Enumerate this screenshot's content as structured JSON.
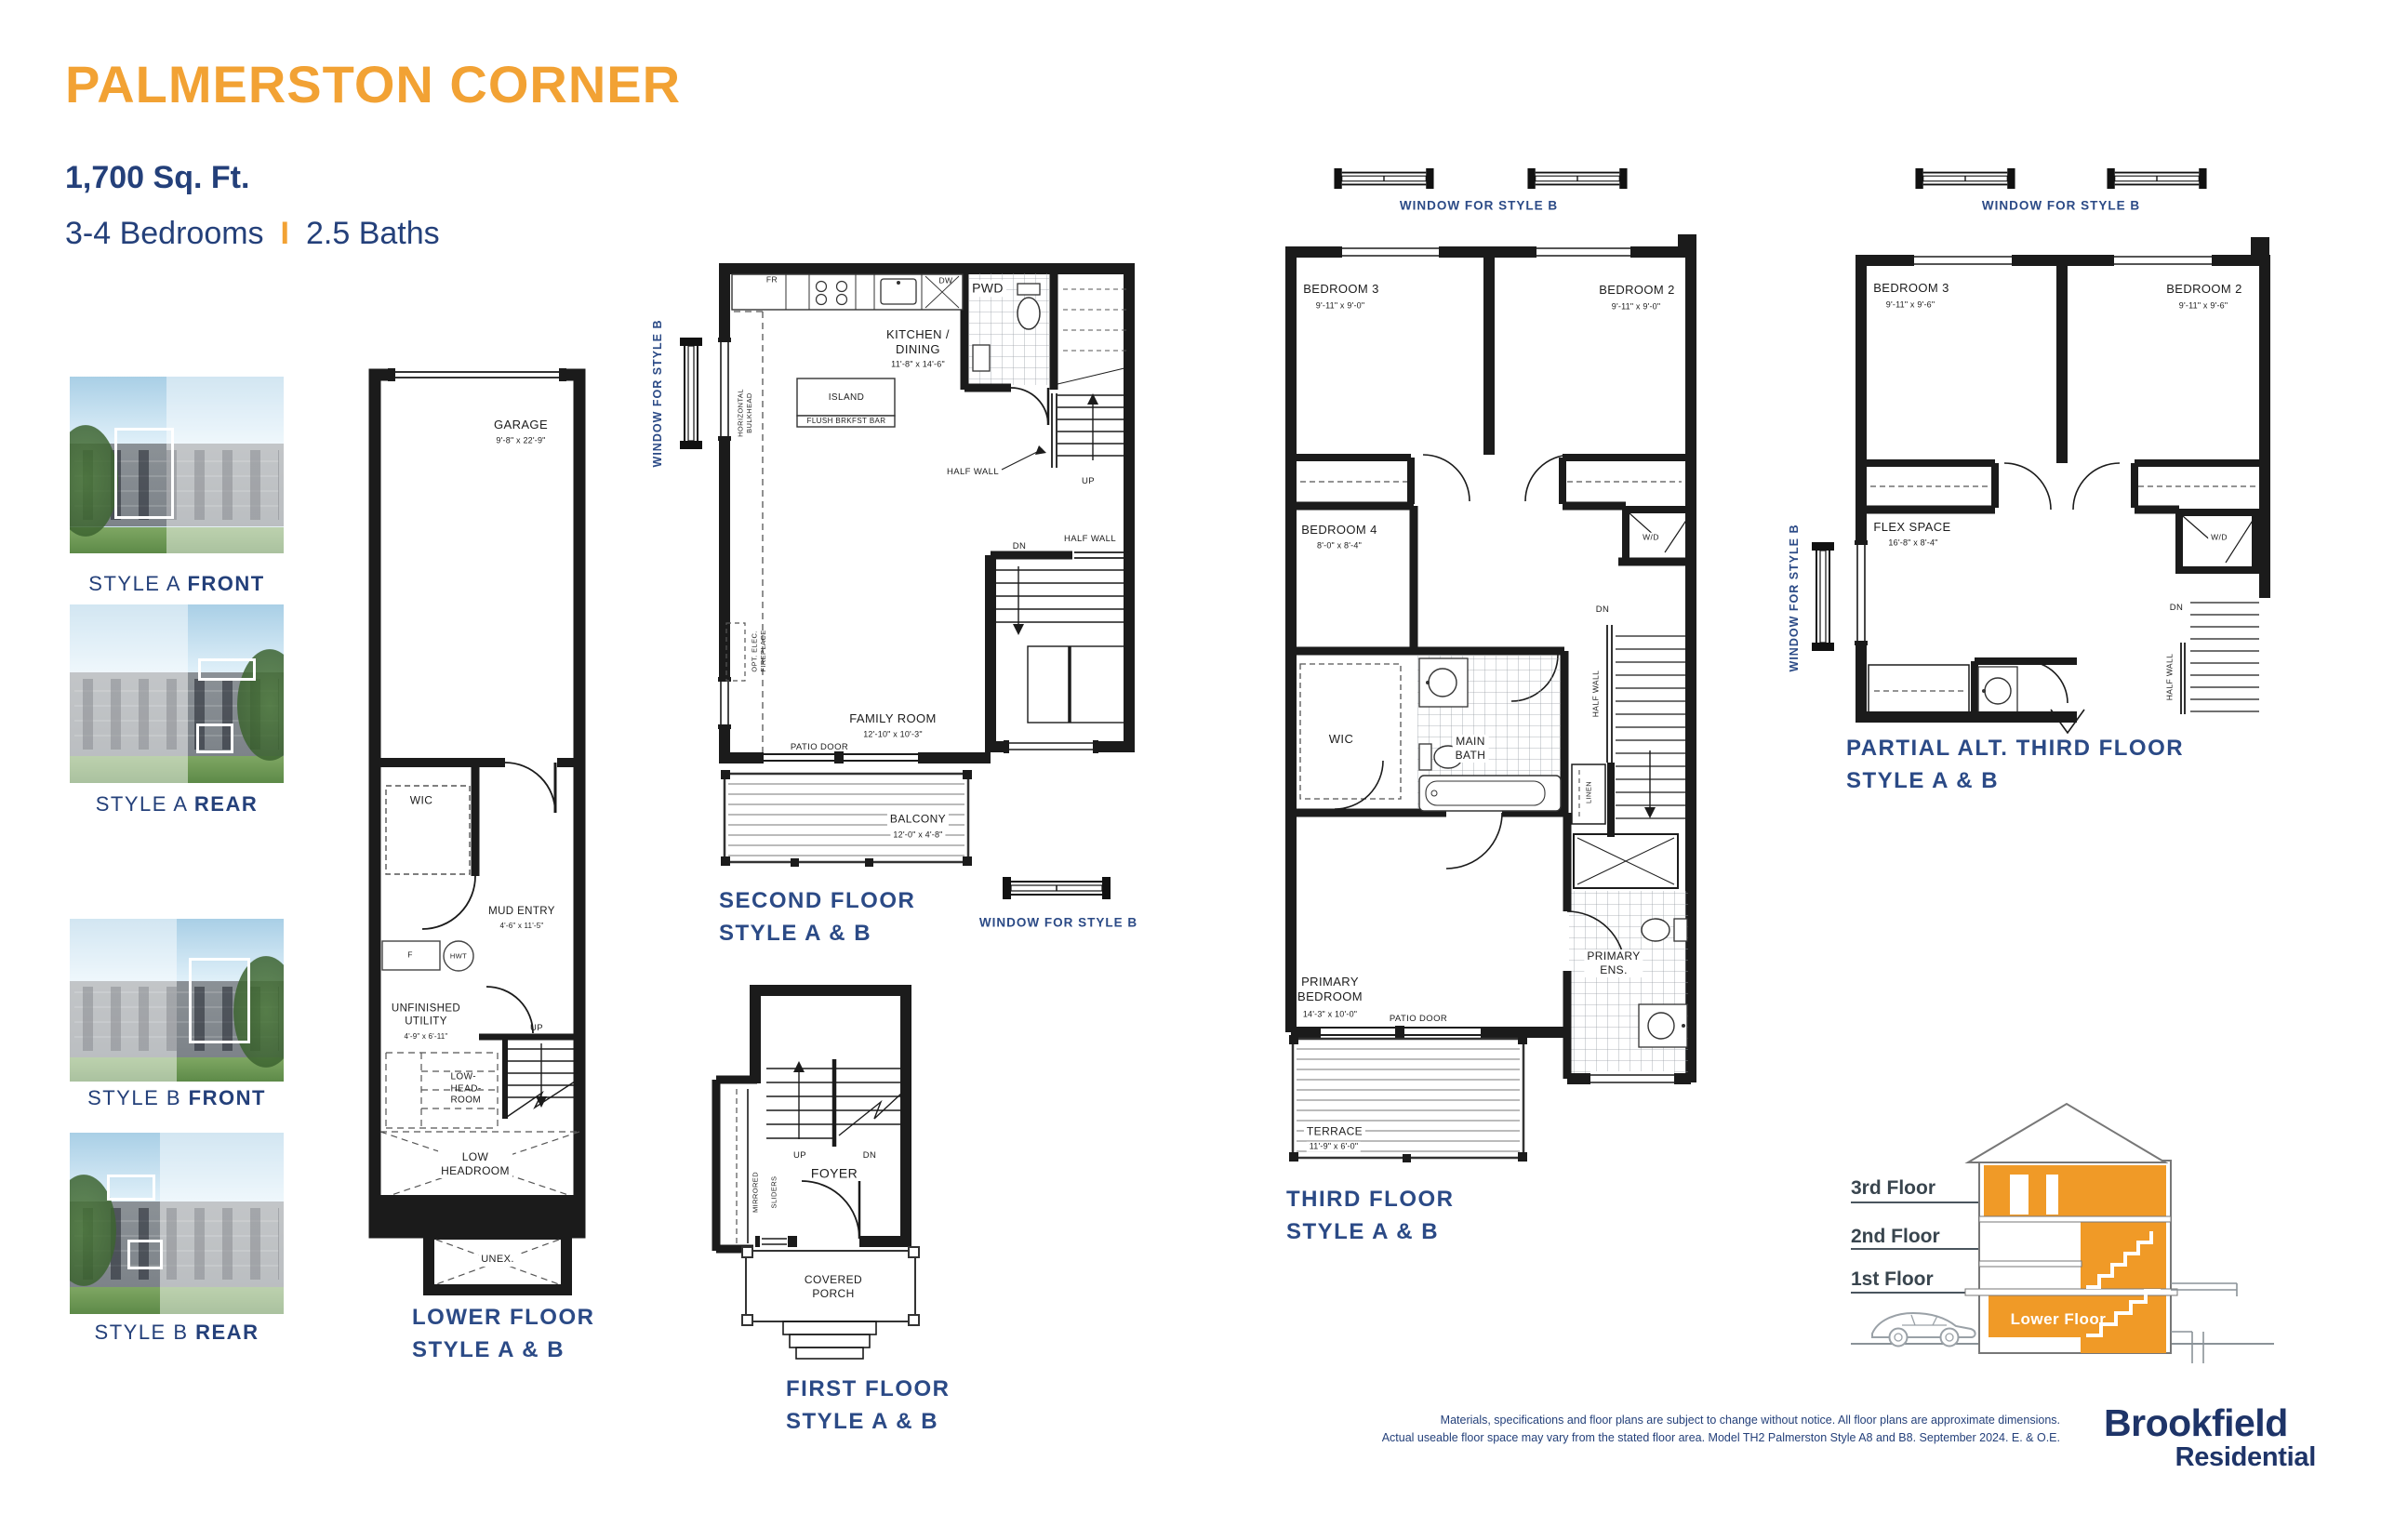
{
  "header": {
    "title": "PALMERSTON CORNER",
    "sqft": "1,700 Sq. Ft.",
    "bedrooms": "3-4 Bedrooms",
    "divider": "I",
    "baths": "2.5 Baths"
  },
  "style_photos": [
    {
      "prefix": "STYLE A ",
      "bold": "FRONT"
    },
    {
      "prefix": "STYLE A ",
      "bold": "REAR"
    },
    {
      "prefix": "STYLE B ",
      "bold": "FRONT"
    },
    {
      "prefix": "STYLE B ",
      "bold": "REAR"
    }
  ],
  "window_note": "WINDOW FOR STYLE B",
  "plans": {
    "lower": {
      "title": "LOWER FLOOR\nSTYLE A & B",
      "garage_name": "GARAGE",
      "garage_dims": "9'-8\" x 22'-9\"",
      "wic": "WIC",
      "mud_name": "MUD ENTRY",
      "mud_dims": "4'-6\" x 11'-5\"",
      "f": "F",
      "hwt": "HWT",
      "utility_name": "UNFINISHED\nUTILITY",
      "utility_dims": "4'-9\" x 6'-11\"",
      "up": "UP",
      "low_head_room": "LOW-\nHEAD-\nROOM",
      "low_headroom": "LOW\nHEADROOM",
      "unex": "UNEX."
    },
    "second": {
      "title": "SECOND FLOOR\nSTYLE A & B",
      "fr": "FR",
      "dw": "DW",
      "pwd": "PWD",
      "kitchen_name": "KITCHEN /\nDINING",
      "kitchen_dims": "11'-8\" x 14'-6\"",
      "island": "ISLAND",
      "brkfst": "FLUSH BRKFST BAR",
      "half_wall": "HALF WALL",
      "up": "UP",
      "dn": "DN",
      "half_wall2": "HALF WALL",
      "family_name": "FAMILY ROOM",
      "family_dims": "12'-10\" x 10'-3\"",
      "patio": "PATIO DOOR",
      "balcony_name": "BALCONY",
      "balcony_dims": "12'-0\" x 4'-8\"",
      "bulkhead": "HORIZONTAL\nBULKHEAD",
      "fireplace": "OPT. ELEC.\nFIREPLACE"
    },
    "first": {
      "title": "FIRST FLOOR\nSTYLE A & B",
      "up": "UP",
      "dn": "DN",
      "foyer": "FOYER",
      "mirrored": "MIRRORED",
      "sliders": "SLIDERS",
      "porch": "COVERED\nPORCH"
    },
    "third": {
      "title": "THIRD FLOOR\nSTYLE A & B",
      "bedroom3_name": "BEDROOM 3",
      "bedroom3_dims": "9'-11\" x 9'-0\"",
      "bedroom2_name": "BEDROOM 2",
      "bedroom2_dims": "9'-11\" x 9'-0\"",
      "bedroom4_name": "BEDROOM 4",
      "bedroom4_dims": "8'-0\" x 8'-4\"",
      "wd": "W/D",
      "dn": "DN",
      "half_wall": "HALF WALL",
      "wic": "WIC",
      "main_bath": "MAIN\nBATH",
      "linen": "LINEN",
      "primary_name": "PRIMARY\nBEDROOM",
      "primary_dims": "14'-3\" x 10'-0\"",
      "patio": "PATIO DOOR",
      "ens": "PRIMARY\nENS.",
      "terrace_name": "TERRACE",
      "terrace_dims": "11'-9\" x 6'-0\""
    },
    "alt_third": {
      "title": "PARTIAL ALT. THIRD FLOOR\nSTYLE A & B",
      "bedroom3_name": "BEDROOM 3",
      "bedroom3_dims": "9'-11\" x 9'-6\"",
      "bedroom2_name": "BEDROOM 2",
      "bedroom2_dims": "9'-11\" x 9'-6\"",
      "flex_name": "FLEX SPACE",
      "flex_dims": "16'-8\" x 8'-4\"",
      "wd": "W/D",
      "dn": "DN",
      "half_wall": "HALF WALL"
    }
  },
  "section": {
    "floor3": "3rd Floor",
    "floor2": "2nd Floor",
    "floor1": "1st Floor",
    "lower": "Lower Floor"
  },
  "footer": {
    "disclaimer1": "Materials, specifications and floor plans are subject to change without notice. All floor plans are approximate dimensions.",
    "disclaimer2": "Actual useable floor space may vary from the stated floor area. Model TH2 Palmerston Style A8 and B8. September 2024. E. & O.E.",
    "brand1": "Brookfield",
    "brand2": "Residential"
  },
  "colors": {
    "accent_orange": "#F2A234",
    "navy": "#24407A",
    "section_orange": "#F09A27"
  }
}
